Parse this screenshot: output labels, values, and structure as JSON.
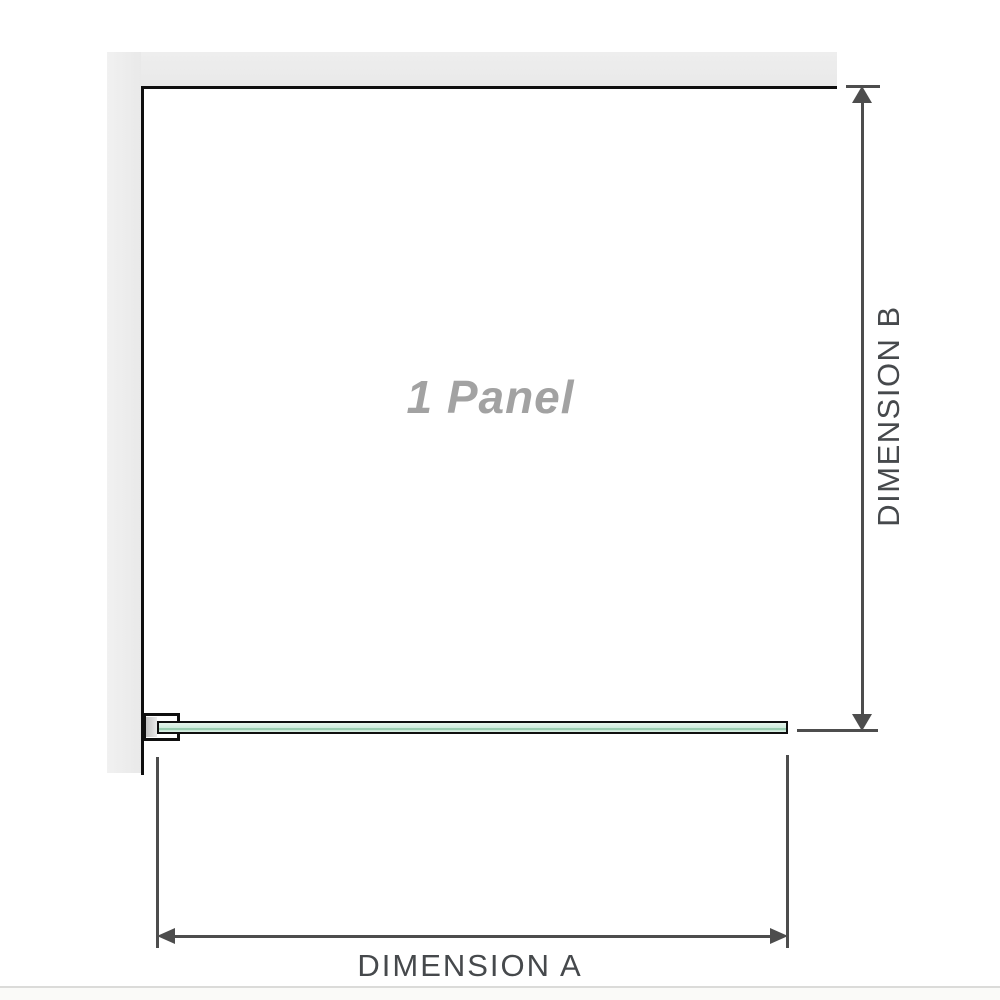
{
  "diagram": {
    "title": "1 Panel shower screen dimension diagram",
    "panel_label": "1 Panel",
    "dimension_a_label": "DIMENSION A",
    "dimension_b_label": "DIMENSION B"
  },
  "icons": {
    "dimension_b_top": "arrow-up-icon",
    "dimension_b_bottom": "arrow-down-icon",
    "dimension_a_left": "arrow-left-icon",
    "dimension_a_right": "arrow-right-icon"
  },
  "colors": {
    "wall": "#e9e9e9",
    "outline": "#0f0f0f",
    "dimension_line": "#4d4d4d",
    "label_text": "#46494c",
    "panel_label_text": "#a2a2a2",
    "glass_green": "#8fc6a7",
    "glass_light": "#d9efe4",
    "divider": "#dbdbd9",
    "footer_bg": "#fafaf8"
  }
}
